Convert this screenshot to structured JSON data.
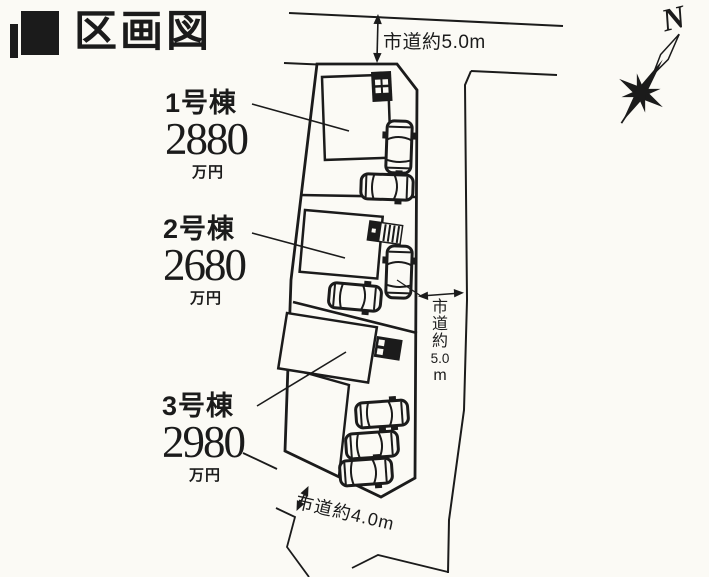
{
  "header": {
    "title": "区画図"
  },
  "compass": {
    "north_label": "N"
  },
  "roads": {
    "top": {
      "label": "市道約5.0m"
    },
    "right": {
      "chars": [
        "市",
        "道",
        "約",
        "5.0",
        "m"
      ],
      "label": "市道約5.0m"
    },
    "bottom": {
      "label": "市道約4.0m"
    }
  },
  "lots": [
    {
      "name": "1号棟",
      "price": "2880",
      "unit": "万円"
    },
    {
      "name": "2号棟",
      "price": "2680",
      "unit": "万円"
    },
    {
      "name": "3号棟",
      "price": "2980",
      "unit": "万円"
    }
  ],
  "colors": {
    "ink": "#1b1b1b",
    "paper": "#fbfaf5"
  }
}
